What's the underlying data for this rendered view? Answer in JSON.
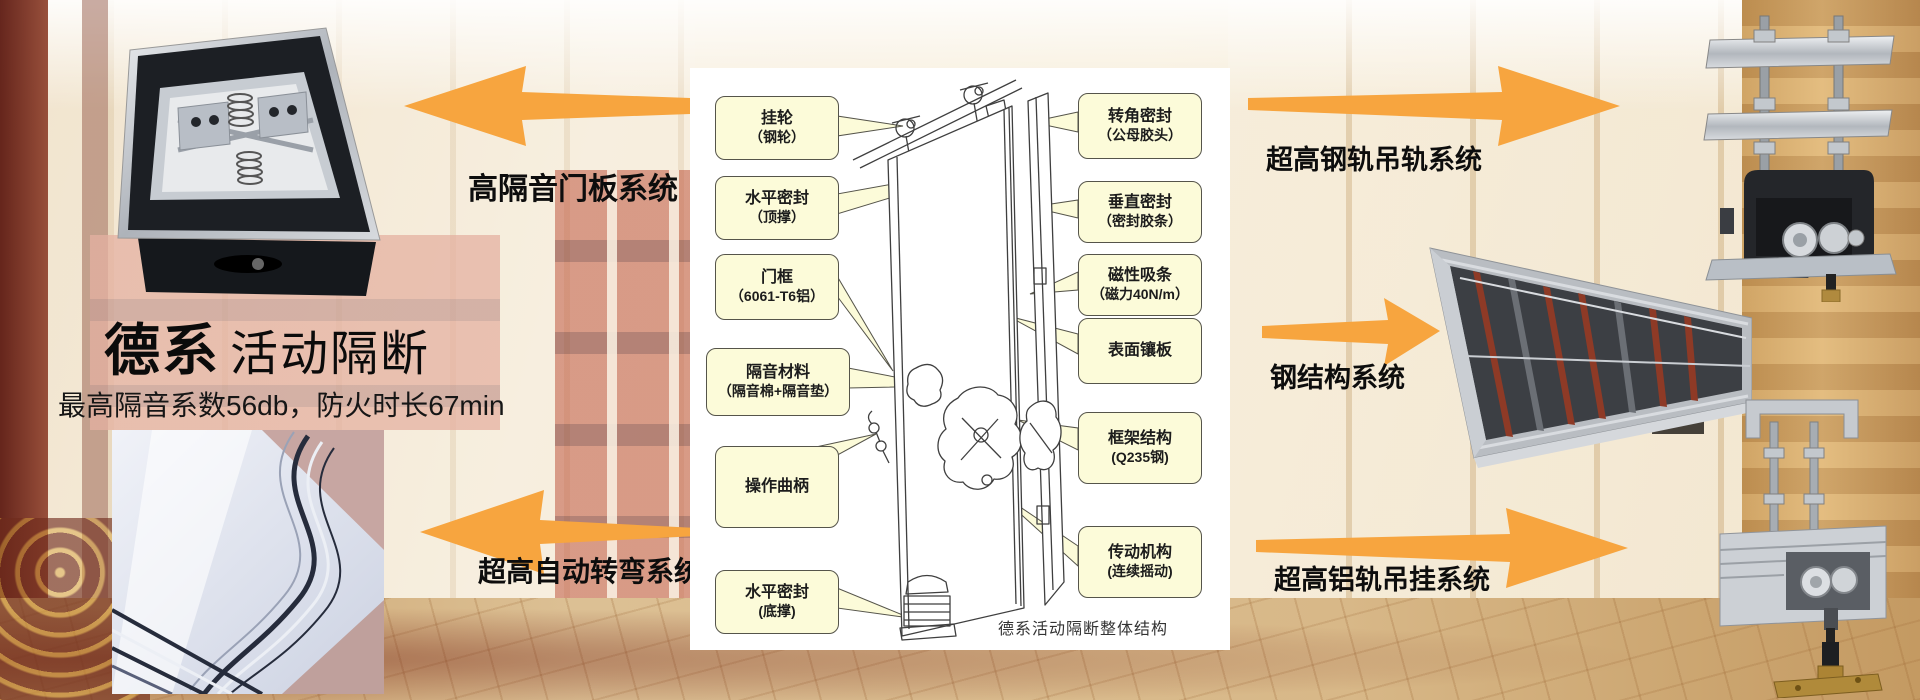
{
  "brand": {
    "title_bold": "德系",
    "title_light": "活动隔断",
    "subtitle": "最高隔音系数56db，防火时长67min"
  },
  "systems": {
    "door_panel": "高隔音门板系统",
    "auto_turn": "超高自动转弯系统",
    "steel_rail": "超高钢轨吊轨系统",
    "steel_structure": "钢结构系统",
    "alu_rail": "超高铝轨吊挂系统"
  },
  "diagram": {
    "caption": "德系活动隔断整体结构",
    "left_callouts": [
      {
        "line1": "挂轮",
        "line2": "（钢轮）"
      },
      {
        "line1": "水平密封",
        "line2": "（顶撑）"
      },
      {
        "line1": "门框",
        "line2": "（6061-T6铝）"
      },
      {
        "line1": "隔音材料",
        "line2": "（隔音棉+隔音垫）"
      },
      {
        "line1": "操作曲柄",
        "line2": ""
      },
      {
        "line1": "水平密封",
        "line2": "(底撑)"
      }
    ],
    "right_callouts": [
      {
        "line1": "转角密封",
        "line2": "（公母胶头）"
      },
      {
        "line1": "垂直密封",
        "line2": "（密封胶条）"
      },
      {
        "line1": "磁性吸条",
        "line2": "（磁力40N/m）"
      },
      {
        "line1": "表面镶板",
        "line2": ""
      },
      {
        "line1": "框架结构",
        "line2": "(Q235钢)"
      },
      {
        "line1": "传动机构",
        "line2": "(连续摇动)"
      }
    ]
  },
  "colors": {
    "arrow": "#F7A53F",
    "callout_bg": "#FCFBD9",
    "callout_border": "#55544A"
  }
}
